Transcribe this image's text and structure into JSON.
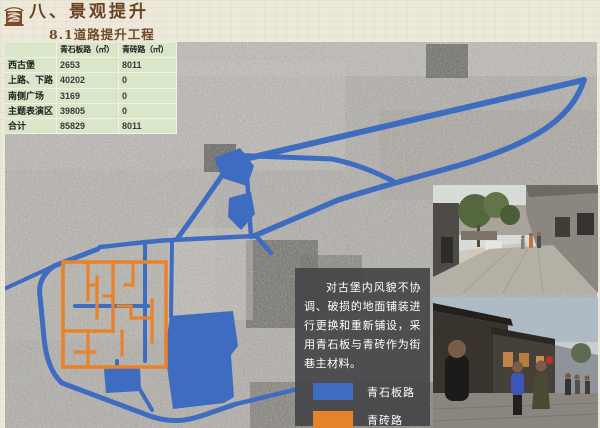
{
  "page": {
    "title": "八、景观提升",
    "subtitle": "8.1道路提升工程"
  },
  "table": {
    "headers": [
      "",
      "青石板路（㎡）",
      "青砖路（㎡）"
    ],
    "rows": [
      {
        "name": "西古堡",
        "stone": "2653",
        "brick": "8011"
      },
      {
        "name": "上路、下路",
        "stone": "40202",
        "brick": "0"
      },
      {
        "name": "南侧广场",
        "stone": "3169",
        "brick": "0"
      },
      {
        "name": "主题表演区",
        "stone": "39805",
        "brick": "0"
      },
      {
        "name": "合计",
        "stone": "85829",
        "brick": "8011"
      }
    ]
  },
  "note": {
    "text": "对古堡内风貌不协调、破损的地面铺装进行更换和重新铺设，采用青石板与青砖作为街巷主材料。"
  },
  "legend": {
    "items": [
      {
        "label": "青石板路",
        "color": "#3e6cc0"
      },
      {
        "label": "青砖路",
        "color": "#e8832d"
      }
    ]
  },
  "map": {
    "kind": "grayscale-satellite-map",
    "overlay_colors": {
      "stone_road_blue": "#3e6cc0",
      "brick_road_orange": "#e8832d"
    }
  },
  "photos": [
    {
      "alt": "古堡街巷铺装照片（白天）"
    },
    {
      "alt": "古堡街巷铺装照片（傍晚）"
    }
  ],
  "theme": {
    "paper": "#ece8da",
    "table_green": "#d9e6c9",
    "title_brown": "#6b4226",
    "note_box_gray": "#464649"
  }
}
